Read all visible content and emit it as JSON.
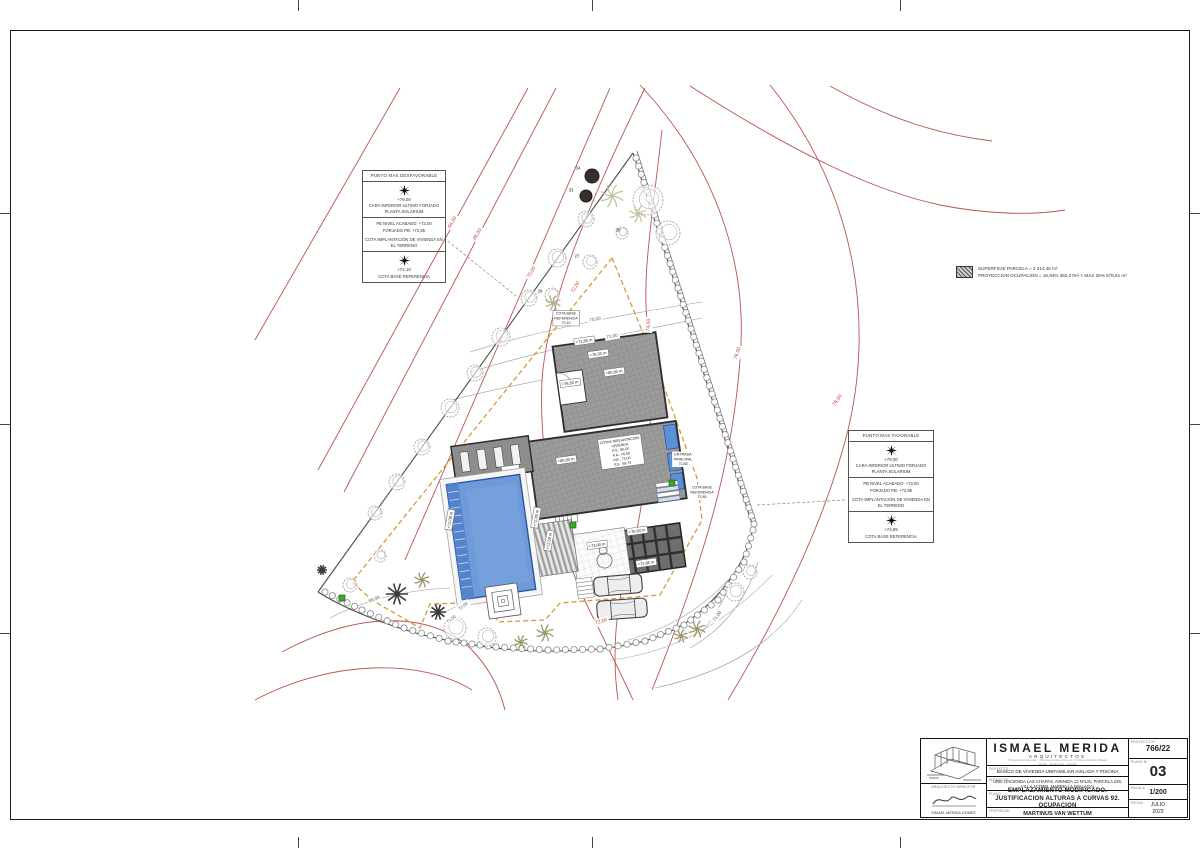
{
  "legend": {
    "line1": "SUPERFICIE PARCELA = 2.314,45 m²",
    "line2": "PROYECCION OCUPACION = 16,94%  392,27m² < MAX 25%  578,61 m²",
    "swatch": "hatched-occupation-swatch"
  },
  "info_left": {
    "title": "PUNTO MAS DESFAVORABLE",
    "row1_value": "+79,00",
    "row1_caption": "CARA INFERIOR ULTIMO FORJADO PLANTA SOLARIUM",
    "row2_line1": "PB NIVEL ACABADO: +73,00",
    "row2_line2": "FORJADO PB: +72,85",
    "row2_caption": "COTA IMPLANTACIÓN DE VIVIENDA EN EL TERRENO",
    "row3_value": "+72,10",
    "row3_caption": "COTA BASE REFERENCIA"
  },
  "info_right": {
    "title": "PUNTO MAS FAVORABLE",
    "row1_value": "+79,00",
    "row1_caption": "CARA INFERIOR ULTIMO FORJADO PLANTA SOLARIUM",
    "row2_line1": "PB NIVEL ACABADO: +73,00",
    "row2_line2": "FORJADO PB: +72,85",
    "row2_caption": "COTA IMPLANTACIÓN DE VIVIENDA EN EL TERRENO",
    "row3_value": "+74,85",
    "row3_caption": "COTA BASE REFERENCIA"
  },
  "title_block": {
    "firm_name": "ISMAEL MERIDA",
    "firm_sub": "ARQUITECTOS",
    "addr1": "Proyectos de Viviendas · Urbanización Res. Oficina 2, 1ª Planta, Marbella, Málaga",
    "addr2": "estudio · arquitectura · marbella",
    "label_proyecto": "PROYECTO",
    "proyecto": "BASICO DE VIVIENDA UNIFAMILIAR AISLADA Y PISCINA",
    "label_situacion": "SITUACION",
    "situacion": "URB. HACIENDA LAS CHAPAS, AVENIDA 12 Nº13V, PARCELA 226, VILLA JAZMIN, MARBELLA (MALAGA)",
    "label_plano": "PLANO",
    "plano": "EMPLAZAMIENTO MODIFICADO. JUSTIFICACION ALTURAS A CURVAS 92. OCUPACION",
    "label_propiedad": "PROPIEDAD",
    "propiedad": "MARTINUS VAN WETTUM",
    "label_proyecto_n": "PROYECTO Nº",
    "proyecto_n": "766/22",
    "label_plano_n": "PLANO Nº",
    "plano_n": "03",
    "label_escala": "ESCALA",
    "escala": "1/200",
    "label_fecha": "FECHA",
    "fecha_l1": "JULIO",
    "fecha_l2": "2023",
    "director_label": "ARQUITECTO DIRECTOR",
    "director_name": "ISMAEL MERIDA GOMEZ"
  },
  "plan": {
    "colors": {
      "red": "#b5403b",
      "black": "#555555",
      "dark": "#222222",
      "gray": "#777777"
    },
    "labels": [
      {
        "n": "contour-label",
        "t": "64,00",
        "x": 452,
        "y": 222,
        "r": -60,
        "c": "red",
        "s": 5,
        "halo": 1
      },
      {
        "n": "contour-label",
        "t": "66,00",
        "x": 477,
        "y": 234,
        "r": -60,
        "c": "red",
        "s": 5,
        "halo": 1
      },
      {
        "n": "contour-label",
        "t": "70,00",
        "x": 531,
        "y": 272,
        "r": -60,
        "c": "red",
        "s": 5,
        "halo": 1
      },
      {
        "n": "contour-label",
        "t": "72,00",
        "x": 575,
        "y": 287,
        "r": -60,
        "c": "red",
        "s": 5,
        "halo": 1
      },
      {
        "n": "contour-label",
        "t": "74,00",
        "x": 648,
        "y": 325,
        "r": -85,
        "c": "red",
        "s": 5,
        "halo": 1
      },
      {
        "n": "contour-label",
        "t": "76,00",
        "x": 737,
        "y": 353,
        "r": -72,
        "c": "red",
        "s": 5,
        "halo": 1
      },
      {
        "n": "contour-label",
        "t": "78,00",
        "x": 837,
        "y": 400,
        "r": -55,
        "c": "red",
        "s": 5,
        "halo": 1
      },
      {
        "n": "contour-label",
        "t": "72,00",
        "x": 601,
        "y": 621,
        "r": -15,
        "c": "red",
        "s": 5,
        "halo": 1
      },
      {
        "n": "contour-label",
        "t": "70,00",
        "x": 595,
        "y": 319,
        "r": -10,
        "c": "black",
        "s": 4.6,
        "halo": 1
      },
      {
        "n": "contour-label",
        "t": "71,00",
        "x": 612,
        "y": 336,
        "r": -10,
        "c": "black",
        "s": 4.6,
        "halo": 1
      },
      {
        "n": "contour-label",
        "t": "69,00",
        "x": 374,
        "y": 599,
        "r": -22,
        "c": "black",
        "s": 4.6,
        "halo": 1
      },
      {
        "n": "contour-label",
        "t": "72,00",
        "x": 463,
        "y": 606,
        "r": -35,
        "c": "black",
        "s": 4.2,
        "halo": 1
      },
      {
        "n": "contour-label",
        "t": "71,00",
        "x": 451,
        "y": 619,
        "r": -35,
        "c": "black",
        "s": 4.2,
        "halo": 1
      },
      {
        "n": "contour-label",
        "t": "71,00",
        "x": 717,
        "y": 616,
        "r": -55,
        "c": "black",
        "s": 4.6,
        "halo": 1
      },
      {
        "n": "tree-number",
        "t": "34",
        "x": 578,
        "y": 168,
        "c": "dark",
        "s": 4.2
      },
      {
        "n": "tree-number",
        "t": "33",
        "x": 571,
        "y": 190,
        "c": "dark",
        "s": 4.2
      },
      {
        "n": "tree-number",
        "t": "30",
        "x": 618,
        "y": 230,
        "c": "dark",
        "s": 4.2
      },
      {
        "n": "tree-number",
        "t": "27",
        "x": 577,
        "y": 256,
        "c": "dark",
        "s": 4.2
      },
      {
        "n": "tree-number",
        "t": "28",
        "x": 540,
        "y": 291,
        "c": "dark",
        "s": 4.2
      },
      {
        "n": "level-label",
        "t": "+71,65 m",
        "x": 584,
        "y": 341,
        "r": -8,
        "c": "dark",
        "s": 4,
        "box": 1
      },
      {
        "n": "level-label",
        "t": "+76,50 m",
        "x": 598,
        "y": 354,
        "r": -8,
        "c": "dark",
        "s": 4,
        "box": 1
      },
      {
        "n": "level-label",
        "t": "+80,00 m",
        "x": 614,
        "y": 372,
        "r": -8,
        "c": "dark",
        "s": 4,
        "box": 1
      },
      {
        "n": "level-label",
        "t": "+76,50 m",
        "x": 570,
        "y": 383,
        "r": -8,
        "c": "dark",
        "s": 4,
        "box": 1
      },
      {
        "n": "level-label",
        "t": "+80,00 m",
        "x": 566,
        "y": 460,
        "r": -8,
        "c": "dark",
        "s": 4,
        "box": 1
      },
      {
        "n": "level-label",
        "t": "+72,00 m",
        "x": 450,
        "y": 520,
        "r": -80,
        "c": "dark",
        "s": 4,
        "box": 1
      },
      {
        "n": "level-label",
        "t": "+72,85 m",
        "x": 536,
        "y": 518,
        "r": -80,
        "c": "dark",
        "s": 4,
        "box": 1
      },
      {
        "n": "level-label",
        "t": "+72,50 m",
        "x": 549,
        "y": 541,
        "r": -80,
        "c": "dark",
        "s": 4,
        "box": 1
      },
      {
        "n": "level-label",
        "t": "+76,50 m",
        "x": 637,
        "y": 531,
        "r": -8,
        "c": "dark",
        "s": 4,
        "box": 1
      },
      {
        "n": "level-label",
        "t": "+72,85 m",
        "x": 646,
        "y": 563,
        "r": -8,
        "c": "dark",
        "s": 4,
        "box": 1
      },
      {
        "n": "level-label",
        "t": "+73,00 m",
        "x": 597,
        "y": 545,
        "r": -8,
        "c": "dark",
        "s": 4,
        "box": 1
      },
      {
        "n": "cota-base-label",
        "t": [
          "COTA BASE",
          "REFERENCIA",
          "72,10"
        ],
        "x": 566,
        "y": 318,
        "c": "dark",
        "s": 3.6,
        "box": 1
      },
      {
        "n": "cota-base-label",
        "t": [
          "COTA BASE",
          "REFERENCIA",
          "72,85"
        ],
        "x": 702,
        "y": 492,
        "c": "dark",
        "s": 3.6,
        "halo": 1
      },
      {
        "n": "entrada-label",
        "t": [
          "ENTRADA",
          "PRINCIPAL",
          "72,85"
        ],
        "x": 683,
        "y": 459,
        "c": "dark",
        "s": 3.6,
        "halo": 1
      },
      {
        "n": "cotas-implantacion-table",
        "t": [
          "COTAS IMPLANTACIÓN",
          "VIVIENDA",
          "P.S.: 80,00",
          "P.A.: 76,50",
          "P.B.: 73,00",
          "P.S.: 69,70"
        ],
        "x": 621,
        "y": 452,
        "r": -8,
        "c": "dark",
        "s": 3.6,
        "box": 1
      }
    ]
  }
}
